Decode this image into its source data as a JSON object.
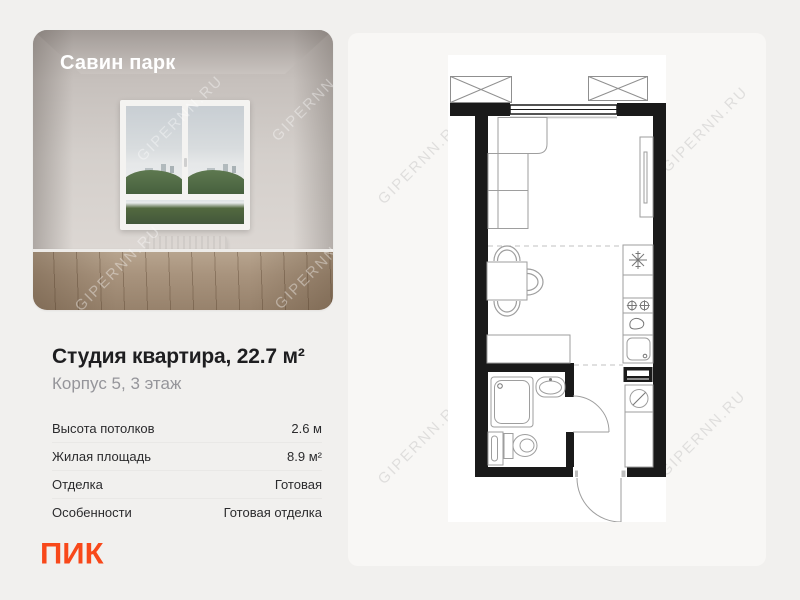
{
  "page": {
    "background": "#F1F0EE",
    "panel_background": "#F8F7F5"
  },
  "photo_card": {
    "project_name": "Савин парк",
    "watermark": "GIPERNN.RU"
  },
  "listing": {
    "title": "Студия квартира, 22.7 м²",
    "subtitle": "Корпус 5, 3 этаж"
  },
  "specs": {
    "rows": [
      {
        "label": "Высота потолков",
        "value": "2.6 м"
      },
      {
        "label": "Жилая площадь",
        "value": "8.9 м²"
      },
      {
        "label": "Отделка",
        "value": "Готовая"
      },
      {
        "label": "Особенности",
        "value": "Готовая отделка"
      }
    ]
  },
  "footer": {
    "logo_text": "ПИК",
    "logo_color": "#F8481A"
  },
  "floor_plan": {
    "watermark": "GIPERNN.RU",
    "wall_color": "#1A1A1A",
    "elements": [
      "balcony-vent-left",
      "balcony-vent-right",
      "window",
      "sofa",
      "dining-table",
      "dining-chairs",
      "wardrobe",
      "fridge",
      "hob",
      "faucet",
      "kitchen-sink",
      "electric-panel",
      "washing-machine",
      "hall-cabinet",
      "closet",
      "shower",
      "washbasin",
      "towel-rail",
      "toilet",
      "bathroom-door",
      "entrance-door"
    ]
  }
}
